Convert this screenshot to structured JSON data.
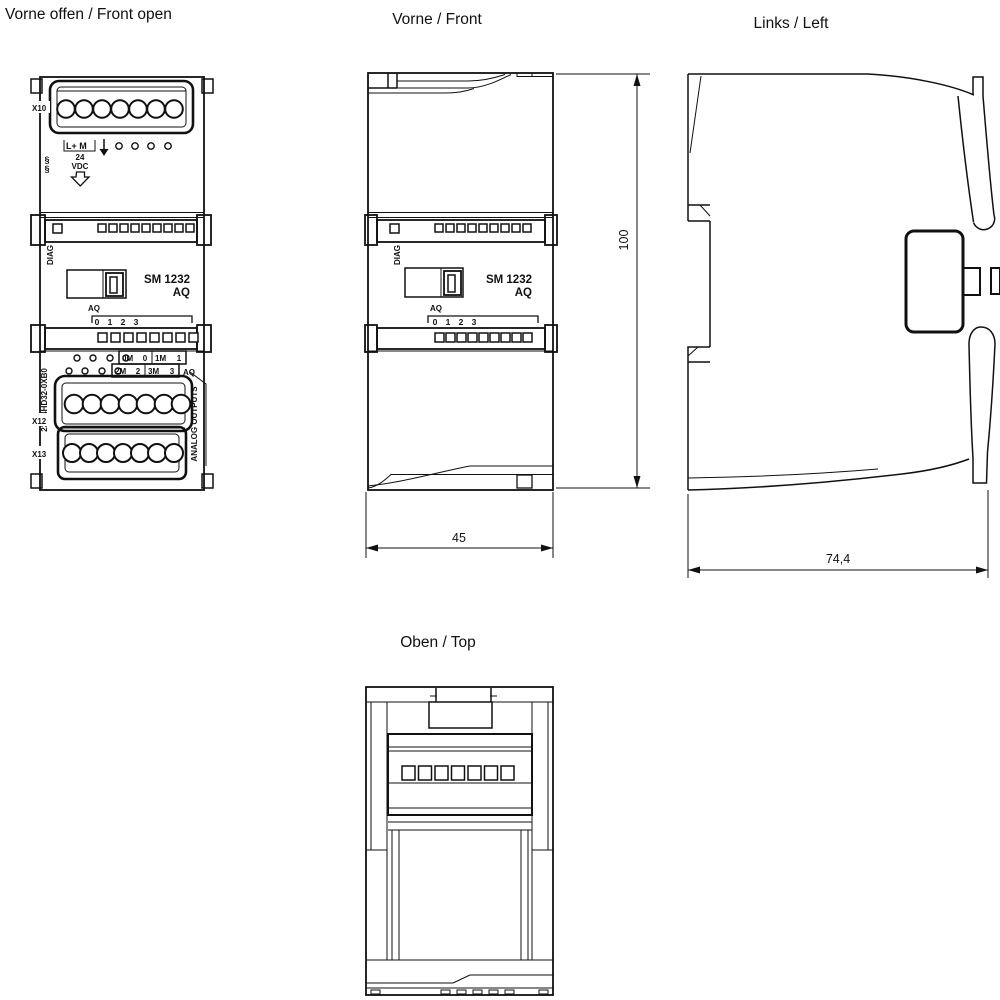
{
  "titles": {
    "front_open": "Vorne offen / Front open",
    "front": "Vorne / Front",
    "left": "Links / Left",
    "top": "Oben / Top"
  },
  "module": {
    "name_line1": "SM 1232",
    "name_line2": "AQ",
    "diag_label": "DIAG",
    "connector_top": "X10",
    "connector_mid": "X12",
    "connector_bottom": "X13",
    "order_number": "232-4HD32-0XB0",
    "power_label": "L+ M",
    "voltage_line1": "24",
    "voltage_line2": "VDC",
    "spring_symbol": "§",
    "aq_label": "AQ",
    "aq_channels": [
      "0",
      "1",
      "2",
      "3"
    ],
    "terminal_row1": [
      "0M",
      "0",
      "1M",
      "1"
    ],
    "terminal_row2": [
      "2M",
      "2",
      "3M",
      "3"
    ],
    "terminal_group_label": "AQ",
    "outputs_label": "ANALOG OUTPUTS"
  },
  "dimensions": {
    "height_mm": "100",
    "width_mm": "45",
    "depth_mm": "74,4"
  },
  "colors": {
    "line": "#111111",
    "background": "#ffffff"
  }
}
